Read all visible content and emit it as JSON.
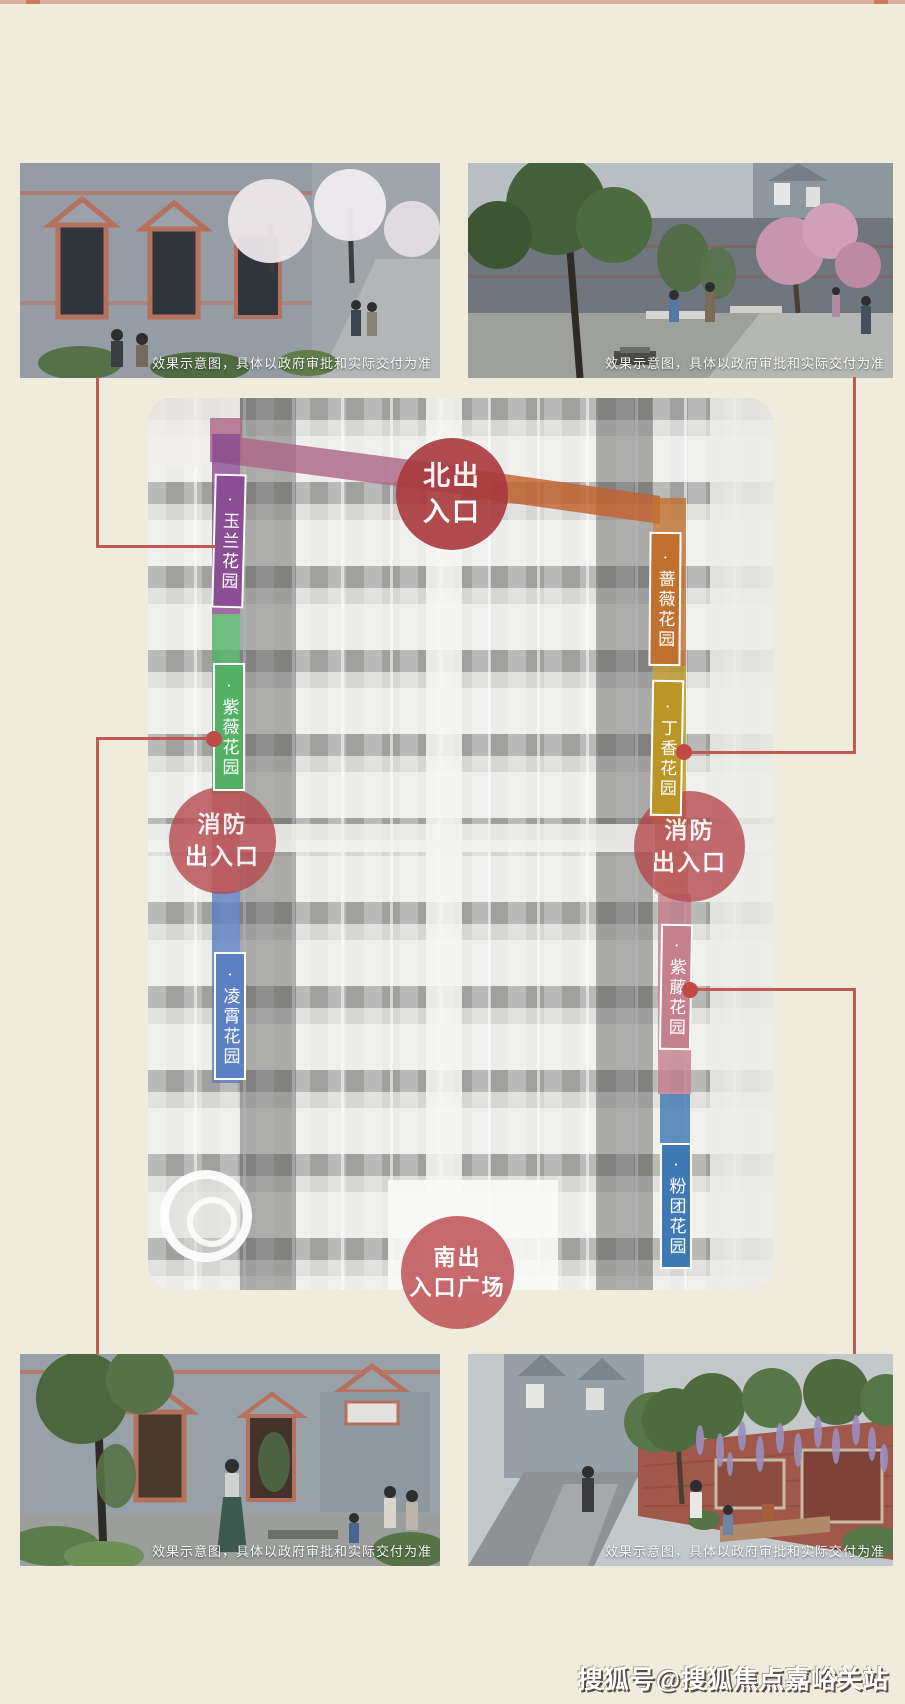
{
  "header": {
    "top_strip_color": "#dcae9f"
  },
  "renderings": {
    "caption": "效果示意图，具体以政府审批和实际交付为准"
  },
  "site_plan": {
    "entrances": {
      "north": {
        "label": "北出\n入口",
        "color": "#a93a3e"
      },
      "fire_left": {
        "label": "消防\n出入口",
        "color": "#b4464b"
      },
      "fire_right": {
        "label": "消防\n出入口",
        "color": "#b4464b"
      },
      "south": {
        "label": "南出\n入口广场",
        "color": "#bf5256"
      }
    },
    "gardens": {
      "yulan": {
        "label": "·玉兰花园",
        "color": "#8a4f92"
      },
      "ziwei": {
        "label": "·紫薇花园",
        "color": "#53b166"
      },
      "lingxiao": {
        "label": "·凌霄花园",
        "color": "#5d80c2"
      },
      "qiangwei": {
        "label": "·蔷薇花园",
        "color": "#c0712f"
      },
      "dingxiang": {
        "label": "·丁香花园",
        "color": "#bb9627"
      },
      "ziteng": {
        "label": "·紫藤花园",
        "color": "#c5808d"
      },
      "fentuan": {
        "label": "·粉团花园",
        "color": "#3f79b3"
      }
    },
    "paths": {
      "north_west": {
        "color": "#ad6787"
      },
      "north_east": {
        "color": "#c2622e"
      }
    },
    "connector_color": "#c25a54",
    "connector_dot_color": "#bf4a46"
  },
  "watermark": {
    "text": "搜狐号@搜狐焦点嘉峪关站"
  }
}
